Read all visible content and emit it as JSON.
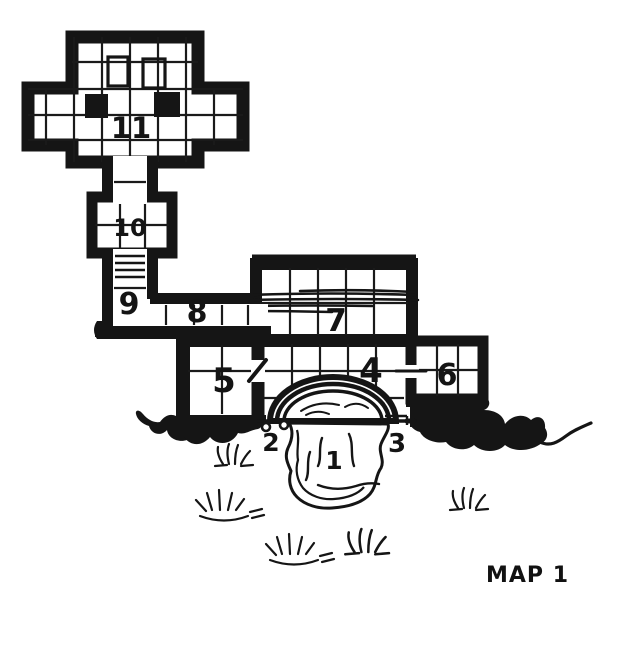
{
  "page": {
    "background": "#ffffff",
    "ink_color": "#151515"
  },
  "map": {
    "title": "MAP 1",
    "labels": {
      "1": "1",
      "2": "2",
      "3": "3",
      "4": "4",
      "5": "5",
      "6": "6",
      "7": "7",
      "8": "8",
      "9": "9",
      "10": "10",
      "11": "11"
    },
    "features": {
      "cave_pool": "1",
      "entrance_left_post": "2",
      "entrance_right_post": "3",
      "stairs": "9"
    }
  }
}
